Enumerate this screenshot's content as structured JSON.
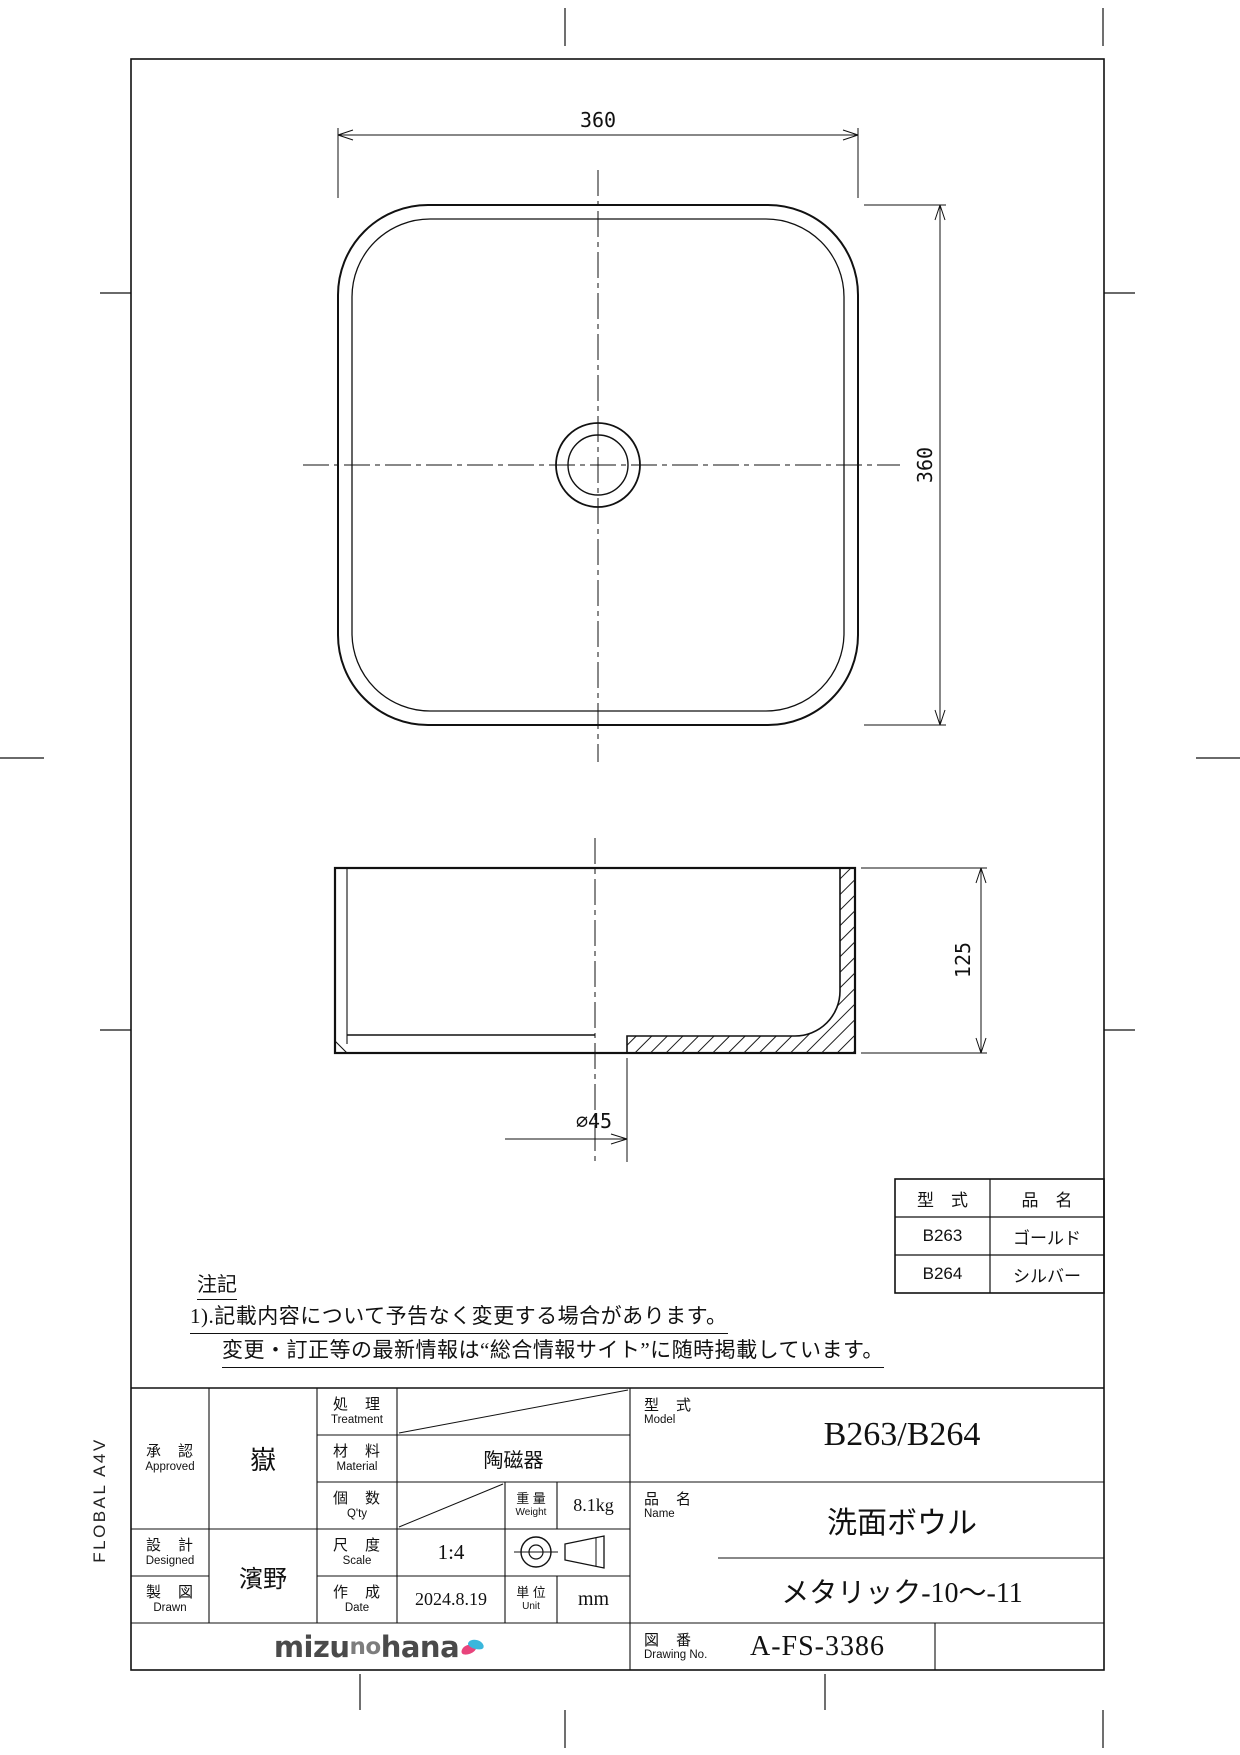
{
  "dims": {
    "plan_width": "360",
    "plan_height": "360",
    "section_height": "125",
    "drain_dia": "∅45"
  },
  "parts_table": {
    "header_model": "型　式",
    "header_name": "品　名",
    "rows": [
      {
        "model": "B263",
        "name": "ゴールド"
      },
      {
        "model": "B264",
        "name": "シルバー"
      }
    ]
  },
  "notes": {
    "heading": "注記",
    "line1": "1).記載内容について予告なく変更する場合があります。",
    "line2": "変更・訂正等の最新情報は“総合情報サイト”に随時掲載しています。"
  },
  "title_block": {
    "approved": {
      "jp": "承　認",
      "en": "Approved",
      "value": "嶽"
    },
    "designed": {
      "jp": "設　計",
      "en": "Designed"
    },
    "drawn": {
      "jp": "製　図",
      "en": "Drawn"
    },
    "designer_value": "濱野",
    "treatment": {
      "jp": "処　理",
      "en": "Treatment"
    },
    "material": {
      "jp": "材　料",
      "en": "Material",
      "value": "陶磁器"
    },
    "qty": {
      "jp": "個　数",
      "en": "Q'ty"
    },
    "weight": {
      "jp": "重 量",
      "en": "Weight",
      "value": "8.1kg"
    },
    "scale": {
      "jp": "尺　度",
      "en": "Scale",
      "value": "1:4"
    },
    "date": {
      "jp": "作　成",
      "en": "Date",
      "value": "2024.8.19"
    },
    "unit": {
      "jp": "単 位",
      "en": "Unit",
      "value": "mm"
    },
    "model": {
      "jp": "型　式",
      "en": "Model",
      "value": "B263/B264"
    },
    "name": {
      "jp": "品　名",
      "en": "Name",
      "value": "洗面ボウル",
      "value2": "メタリック-10～-11"
    },
    "drawing_no": {
      "jp": "図　番",
      "en": "Drawing No.",
      "value": "A-FS-3386"
    }
  },
  "logo": {
    "t1": "mizu",
    "t2": "no",
    "t3": "hana"
  },
  "sheet": {
    "side_label": "FLOBAL A4V"
  }
}
